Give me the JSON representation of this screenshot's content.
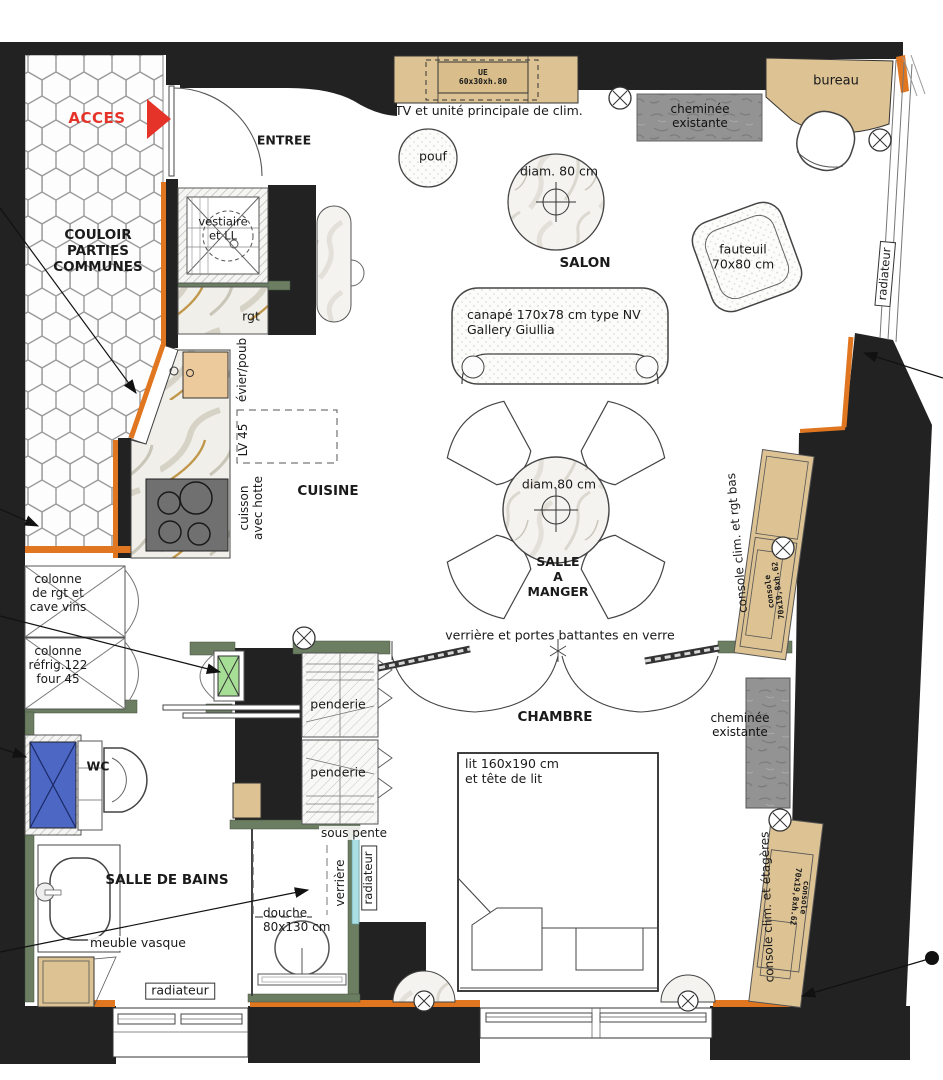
{
  "meta": {
    "type": "apartment-floor-plan",
    "language": "fr"
  },
  "colors": {
    "wall": "#222222",
    "insulation_orange": "#e0761f",
    "wood_tan": "#ddc394",
    "partition_green": "#6c7e62",
    "chimney_gray": "#939393",
    "wc_blue": "#4c67c4",
    "fridge_green": "#a6de96",
    "access_red": "#e5332a",
    "glass_cyan": "#aadfe4"
  },
  "corridor": {
    "access": "ACCES",
    "name": "COULOIR\nPARTIES\nCOMMUNES"
  },
  "entry": {
    "name": "ENTREE",
    "closet": "vestiaire\net LL",
    "storage": "rgt"
  },
  "salon": {
    "name": "SALON",
    "tv": "TV et unité principale de clim.",
    "tv_unit": "UE\n60x30xh.80",
    "pouf": "pouf",
    "table": "diam. 80 cm",
    "sofa": "canapé 170x78 cm type NV\nGallery Giullia",
    "armchair": "fauteuil\n70x80 cm",
    "fireplace": "cheminée\nexistante",
    "desk": "bureau",
    "radiator": "radiateur"
  },
  "kitchen": {
    "name": "CUISINE",
    "sink": "évier/poub",
    "dishwasher": "LV 45",
    "hob": "cuisson\navec hotte"
  },
  "dining": {
    "name": "SALLE\nA\nMANGER",
    "table": "diam.80 cm"
  },
  "storage": {
    "column1": "colonne\nde rgt et\ncave vins",
    "column2": "colonne\nréfrig.122\nfour 45"
  },
  "living_console": {
    "label": "console clim. et rgt bas",
    "size": "console\n70x19,8xh.62"
  },
  "bedroom": {
    "name": "CHAMBRE",
    "glazing": "verrière et portes battantes en verre",
    "wardrobe_top": "penderie",
    "wardrobe_bottom": "penderie",
    "bed": "lit 160x190 cm\net tête de lit",
    "fireplace": "cheminée\nexistante",
    "console_label": "console clim. et étagères",
    "console_size": "console\n70x19,8xh.62"
  },
  "wc": {
    "name": "WC"
  },
  "bathroom": {
    "name": "SALLE DE BAINS",
    "vanity": "meuble vasque",
    "radiator": "radiateur",
    "shower": "douche\n80x130 cm",
    "sloped_ceiling": "sous pente",
    "glazing": "verrière",
    "shower_radiator": "radiateur"
  }
}
